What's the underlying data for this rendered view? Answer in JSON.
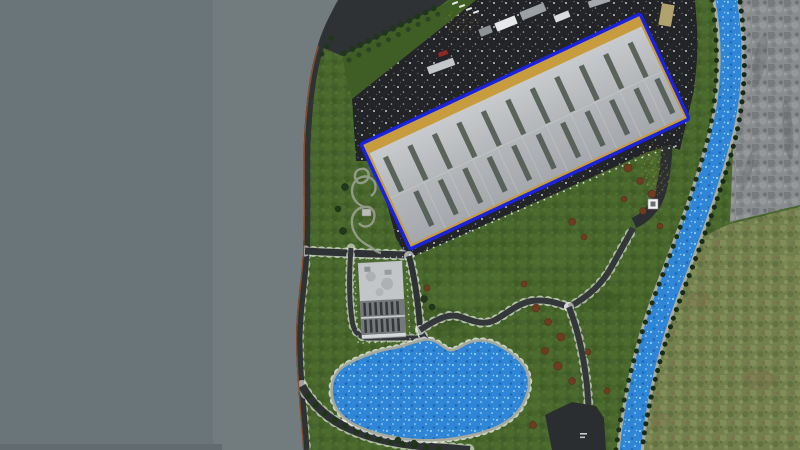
{
  "meta": {
    "title": "Aerial site view — riverside warehouse complex"
  },
  "colors": {
    "void_left": "#6a757a",
    "void_right": "#727c7e",
    "void_bottom_strip": "#616b70",
    "grass_base": "#46642b",
    "asphalt": "#222427",
    "road": "#2f3234",
    "cliff_edge": "#8a4a30",
    "river_blue": "#2f86d6",
    "shore": "#a9ada1",
    "rock_base": "#898d8f",
    "moss_base": "#73804e",
    "selection_blue": "#1a22dd",
    "apron_tan": "#c79c3f",
    "roof_light": "#c8cbce",
    "roof_mid": "#b5b8bb",
    "roof_dark": "#a4a8ac",
    "vent_gray": "#4f5a50",
    "office_light": "#b9bcbe",
    "office_dark": "#76797c",
    "tree_dark": "#22381c",
    "bush_brown": "#6f3c22",
    "path_light": "#9aa092",
    "dot_white": "#ebeded"
  },
  "scene": {
    "description": "Top-down aerial render: gray void at left, green terrain with a large blue-outlined warehouse, parking lots with white speckle markings, an office block, an irregular pond with gray shore path, winding dark footpaths with white edge lights, a blue river with rocky and mossy banks on the right, tree rows along roads and river, rust-brown bushes on the lawn.",
    "selected_building": {
      "type": "warehouse",
      "outline": "blue selection outline with tan apron",
      "center": [
        525,
        132
      ],
      "size": [
        308,
        116
      ],
      "rotation_deg": -25,
      "roof_vents": 22
    },
    "office_building": {
      "center": [
        382,
        300
      ],
      "size": [
        44,
        76
      ],
      "rotation_deg": -3
    },
    "pond": {
      "bbox": [
        333,
        339,
        530,
        441
      ]
    },
    "river": {
      "from": [
        725,
        0
      ],
      "to": [
        630,
        450
      ],
      "width": 21
    },
    "vehicles": [
      {
        "name": "trailer-white",
        "x": 495,
        "y": 19,
        "w": 22,
        "h": 9,
        "rot": -22,
        "color": "#e6e8ea"
      },
      {
        "name": "trailer-gray",
        "x": 520,
        "y": 7,
        "w": 26,
        "h": 9,
        "rot": -22,
        "color": "#9aa0a4"
      },
      {
        "name": "van-gray",
        "x": 479,
        "y": 27,
        "w": 13,
        "h": 8,
        "rot": -22,
        "color": "#8d9296"
      },
      {
        "name": "bus-light",
        "x": 427,
        "y": 62,
        "w": 28,
        "h": 8,
        "rot": -20,
        "color": "#c5c8cb"
      },
      {
        "name": "car-red",
        "x": 438,
        "y": 51,
        "w": 10,
        "h": 5,
        "rot": -20,
        "color": "#8a2a22"
      },
      {
        "name": "truck-gray",
        "x": 588,
        "y": -2,
        "w": 22,
        "h": 7,
        "rot": -18,
        "color": "#a6aaae"
      },
      {
        "name": "trailer-small",
        "x": 554,
        "y": 13,
        "w": 16,
        "h": 7,
        "rot": -22,
        "color": "#d9dcde"
      },
      {
        "name": "truck-tan",
        "x": 660,
        "y": 4,
        "w": 13,
        "h": 22,
        "rot": 10,
        "color": "#b2a26e"
      }
    ],
    "bushes": [
      {
        "x": 628,
        "y": 168,
        "r": 4
      },
      {
        "x": 640,
        "y": 181,
        "r": 3.5
      },
      {
        "x": 652,
        "y": 194,
        "r": 4
      },
      {
        "x": 624,
        "y": 199,
        "r": 3
      },
      {
        "x": 643,
        "y": 211,
        "r": 3.5
      },
      {
        "x": 660,
        "y": 226,
        "r": 3
      },
      {
        "x": 572,
        "y": 222,
        "r": 3.5
      },
      {
        "x": 584,
        "y": 237,
        "r": 3
      },
      {
        "x": 536,
        "y": 308,
        "r": 4
      },
      {
        "x": 548,
        "y": 322,
        "r": 3.5
      },
      {
        "x": 561,
        "y": 337,
        "r": 4
      },
      {
        "x": 545,
        "y": 351,
        "r": 3.5
      },
      {
        "x": 558,
        "y": 366,
        "r": 4
      },
      {
        "x": 572,
        "y": 381,
        "r": 3.5
      },
      {
        "x": 588,
        "y": 352,
        "r": 3
      },
      {
        "x": 524,
        "y": 284,
        "r": 3
      },
      {
        "x": 607,
        "y": 391,
        "r": 3
      },
      {
        "x": 533,
        "y": 425,
        "r": 3.5
      },
      {
        "x": 427,
        "y": 288,
        "r": 3
      }
    ],
    "lawn_trees": [
      {
        "x": 424,
        "y": 299,
        "r": 3.5
      },
      {
        "x": 432,
        "y": 307,
        "r": 3
      },
      {
        "x": 345,
        "y": 187,
        "r": 3.5
      },
      {
        "x": 338,
        "y": 209,
        "r": 3
      },
      {
        "x": 343,
        "y": 231,
        "r": 3.5
      },
      {
        "x": 414,
        "y": 443,
        "r": 3
      },
      {
        "x": 398,
        "y": 440,
        "r": 3
      }
    ],
    "park_structure": {
      "x": 362,
      "y": 209,
      "w": 9,
      "h": 7
    },
    "utility_box": {
      "x": 648,
      "y": 199,
      "w": 10,
      "h": 10
    }
  }
}
